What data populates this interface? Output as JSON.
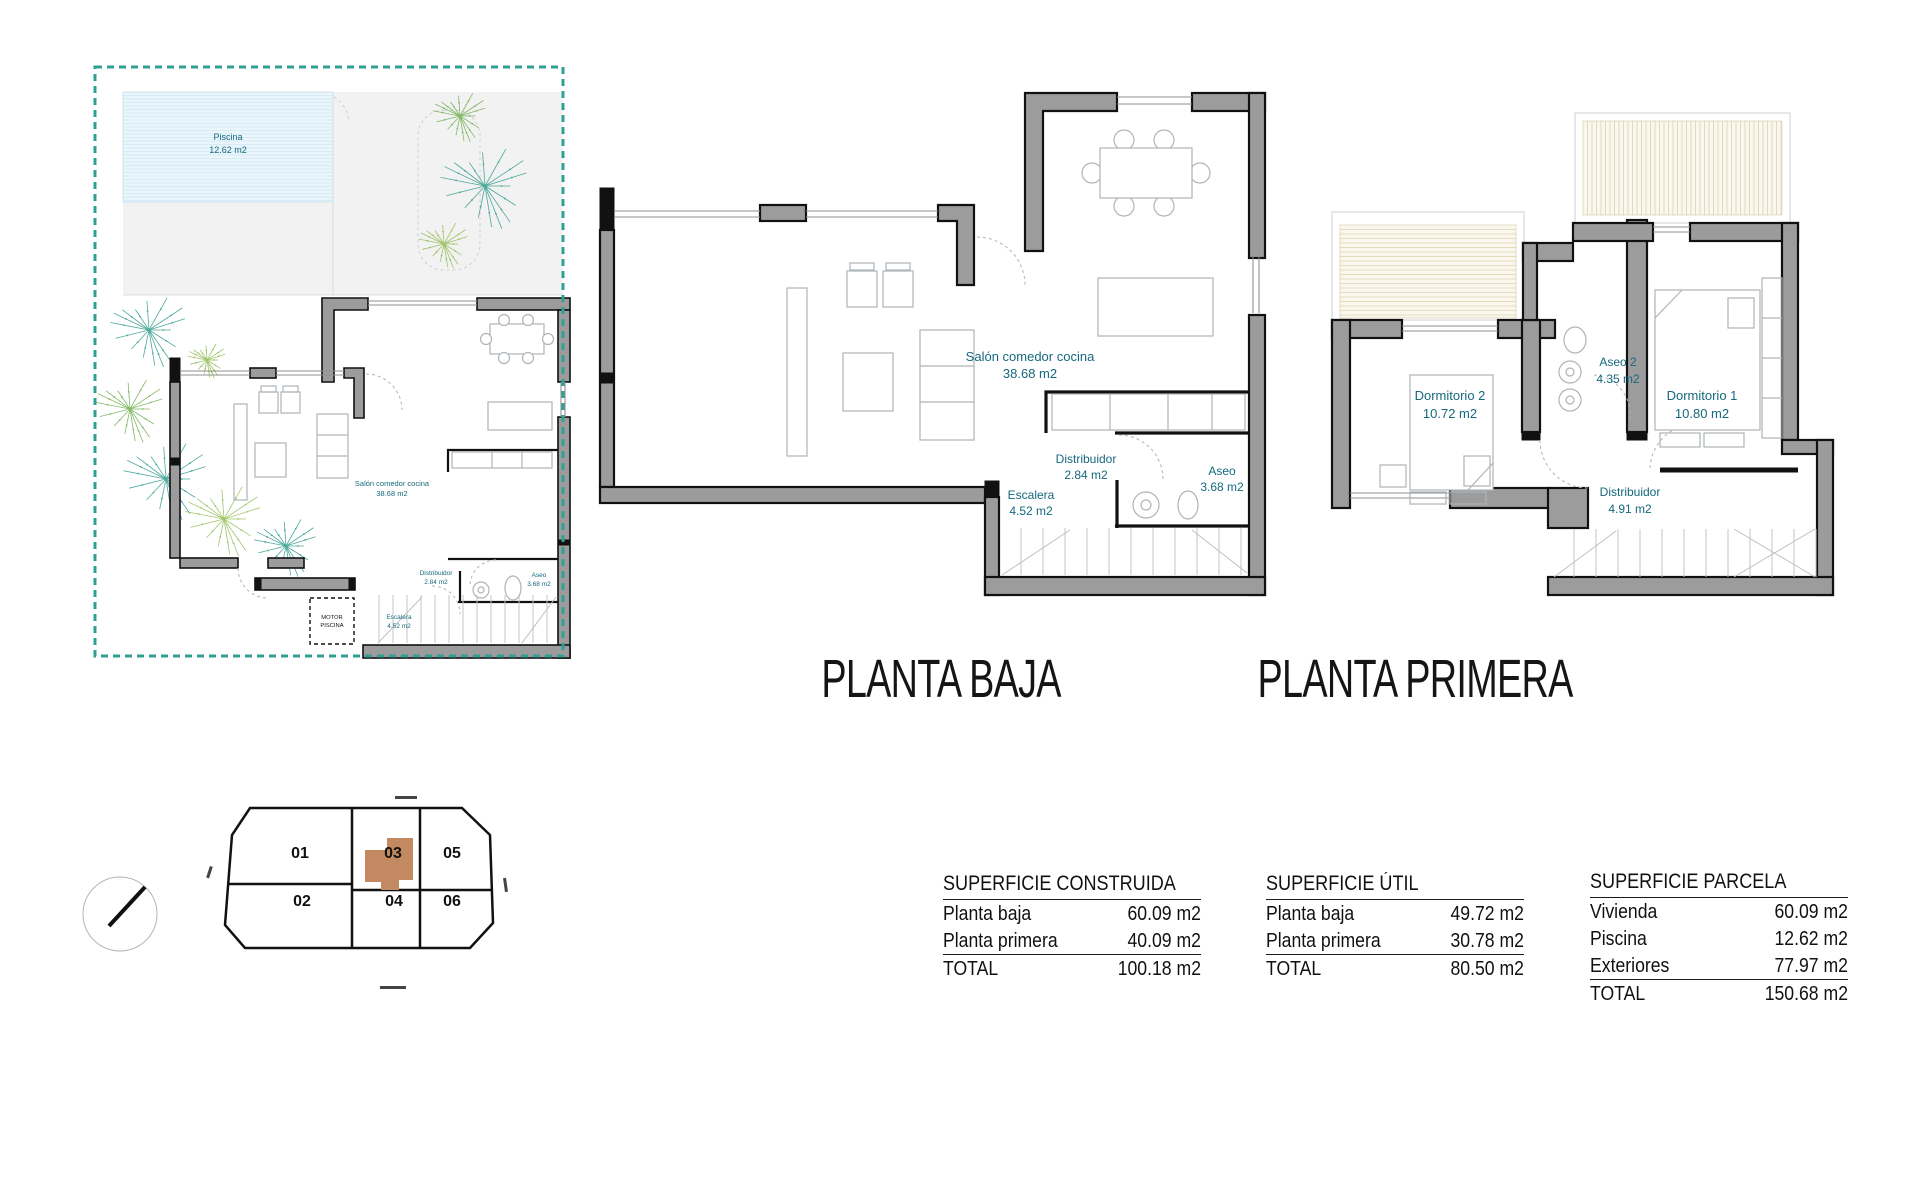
{
  "colors": {
    "label_teal": "#15697d",
    "wall_gray": "#9c9c9c",
    "parcel_teal": "#2fa193",
    "pool_blue": "#eaf6fb",
    "plot_highlight": "#c38a61",
    "terrace_cream": "#faf7ee"
  },
  "site_plan": {
    "pool": {
      "label": "Piscina",
      "area": "12.62 m2"
    },
    "motor": {
      "line1": "MOTOR",
      "line2": "PISCINA"
    }
  },
  "planta_baja": {
    "title": "PLANTA BAJA",
    "rooms": {
      "salon": {
        "label": "Salón comedor cocina",
        "area": "38.68 m2"
      },
      "distribuidor": {
        "label": "Distribuidor",
        "area": "2.84 m2"
      },
      "aseo": {
        "label": "Aseo",
        "area": "3.68 m2"
      },
      "escalera": {
        "label": "Escalera",
        "area": "4.52 m2"
      }
    }
  },
  "planta_primera": {
    "title": "PLANTA PRIMERA",
    "rooms": {
      "dormitorio2": {
        "label": "Dormitorio 2",
        "area": "10.72 m2"
      },
      "aseo2": {
        "label": "Aseo 2",
        "area": "4.35 m2"
      },
      "dormitorio1": {
        "label": "Dormitorio 1",
        "area": "10.80 m2"
      },
      "distribuidor": {
        "label": "Distribuidor",
        "area": "4.91 m2"
      }
    }
  },
  "plot_map": {
    "plots": [
      "01",
      "02",
      "03",
      "04",
      "05",
      "06"
    ],
    "highlighted_plot": "03"
  },
  "tables": [
    {
      "title": "SUPERFICIE CONSTRUIDA",
      "rows": [
        {
          "label": "Planta baja",
          "value": "60.09 m2"
        },
        {
          "label": "Planta primera",
          "value": "40.09 m2"
        }
      ],
      "total_label": "TOTAL",
      "total_value": "100.18 m2"
    },
    {
      "title": "SUPERFICIE ÚTIL",
      "rows": [
        {
          "label": "Planta baja",
          "value": "49.72 m2"
        },
        {
          "label": "Planta primera",
          "value": "30.78 m2"
        }
      ],
      "total_label": "TOTAL",
      "total_value": "80.50 m2"
    },
    {
      "title": "SUPERFICIE PARCELA",
      "rows": [
        {
          "label": "Vivienda",
          "value": "60.09 m2"
        },
        {
          "label": "Piscina",
          "value": "12.62 m2"
        },
        {
          "label": "Exteriores",
          "value": "77.97 m2"
        }
      ],
      "total_label": "TOTAL",
      "total_value": "150.68 m2"
    }
  ]
}
